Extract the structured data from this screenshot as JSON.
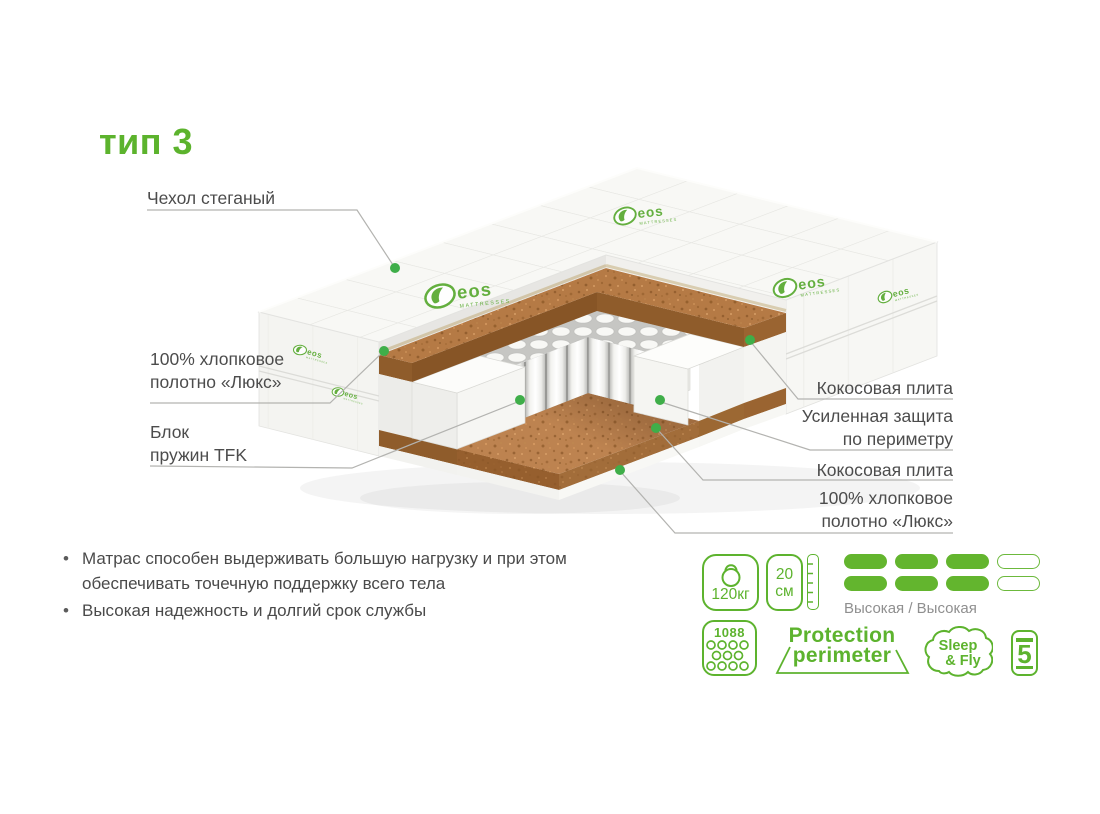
{
  "title": "тип 3",
  "accent_green": "#5db32e",
  "marker_green": "#3fae49",
  "brand_logo": {
    "name": "eos",
    "sub": "MATTRESSES"
  },
  "callouts": {
    "cover": {
      "text": "Чехол стеганый"
    },
    "cotton_left": {
      "line1": "100% хлопковое",
      "line2": "полотно «Люкс»"
    },
    "spring_block": {
      "line1": "Блок",
      "line2": "пружин TFK"
    },
    "coco_plate_top": {
      "text": "Кокосовая плита"
    },
    "perimeter": {
      "line1": "Усиленная защита",
      "line2": "по периметру"
    },
    "coco_plate_bottom": {
      "text": "Кокосовая плита"
    },
    "cotton_right": {
      "line1": "100% хлопковое",
      "line2": "полотно «Люкс»"
    }
  },
  "features": [
    "Матрас способен выдерживать большую нагрузку и при этом обеспечивать точечную поддержку всего тела",
    "Высокая надежность и долгий срок службы"
  ],
  "specs": {
    "max_weight": "120кг",
    "height_value": "20",
    "height_unit": "см",
    "firmness": {
      "label": "Высокая / Высокая",
      "filled": 3,
      "total": 4,
      "rows": 2
    },
    "springs_count": "1088",
    "protection": {
      "line1": "Protection",
      "line2": "perimeter"
    },
    "brand": {
      "line1": "Sleep",
      "line2": "& Fly"
    },
    "warranty_years": "5"
  }
}
